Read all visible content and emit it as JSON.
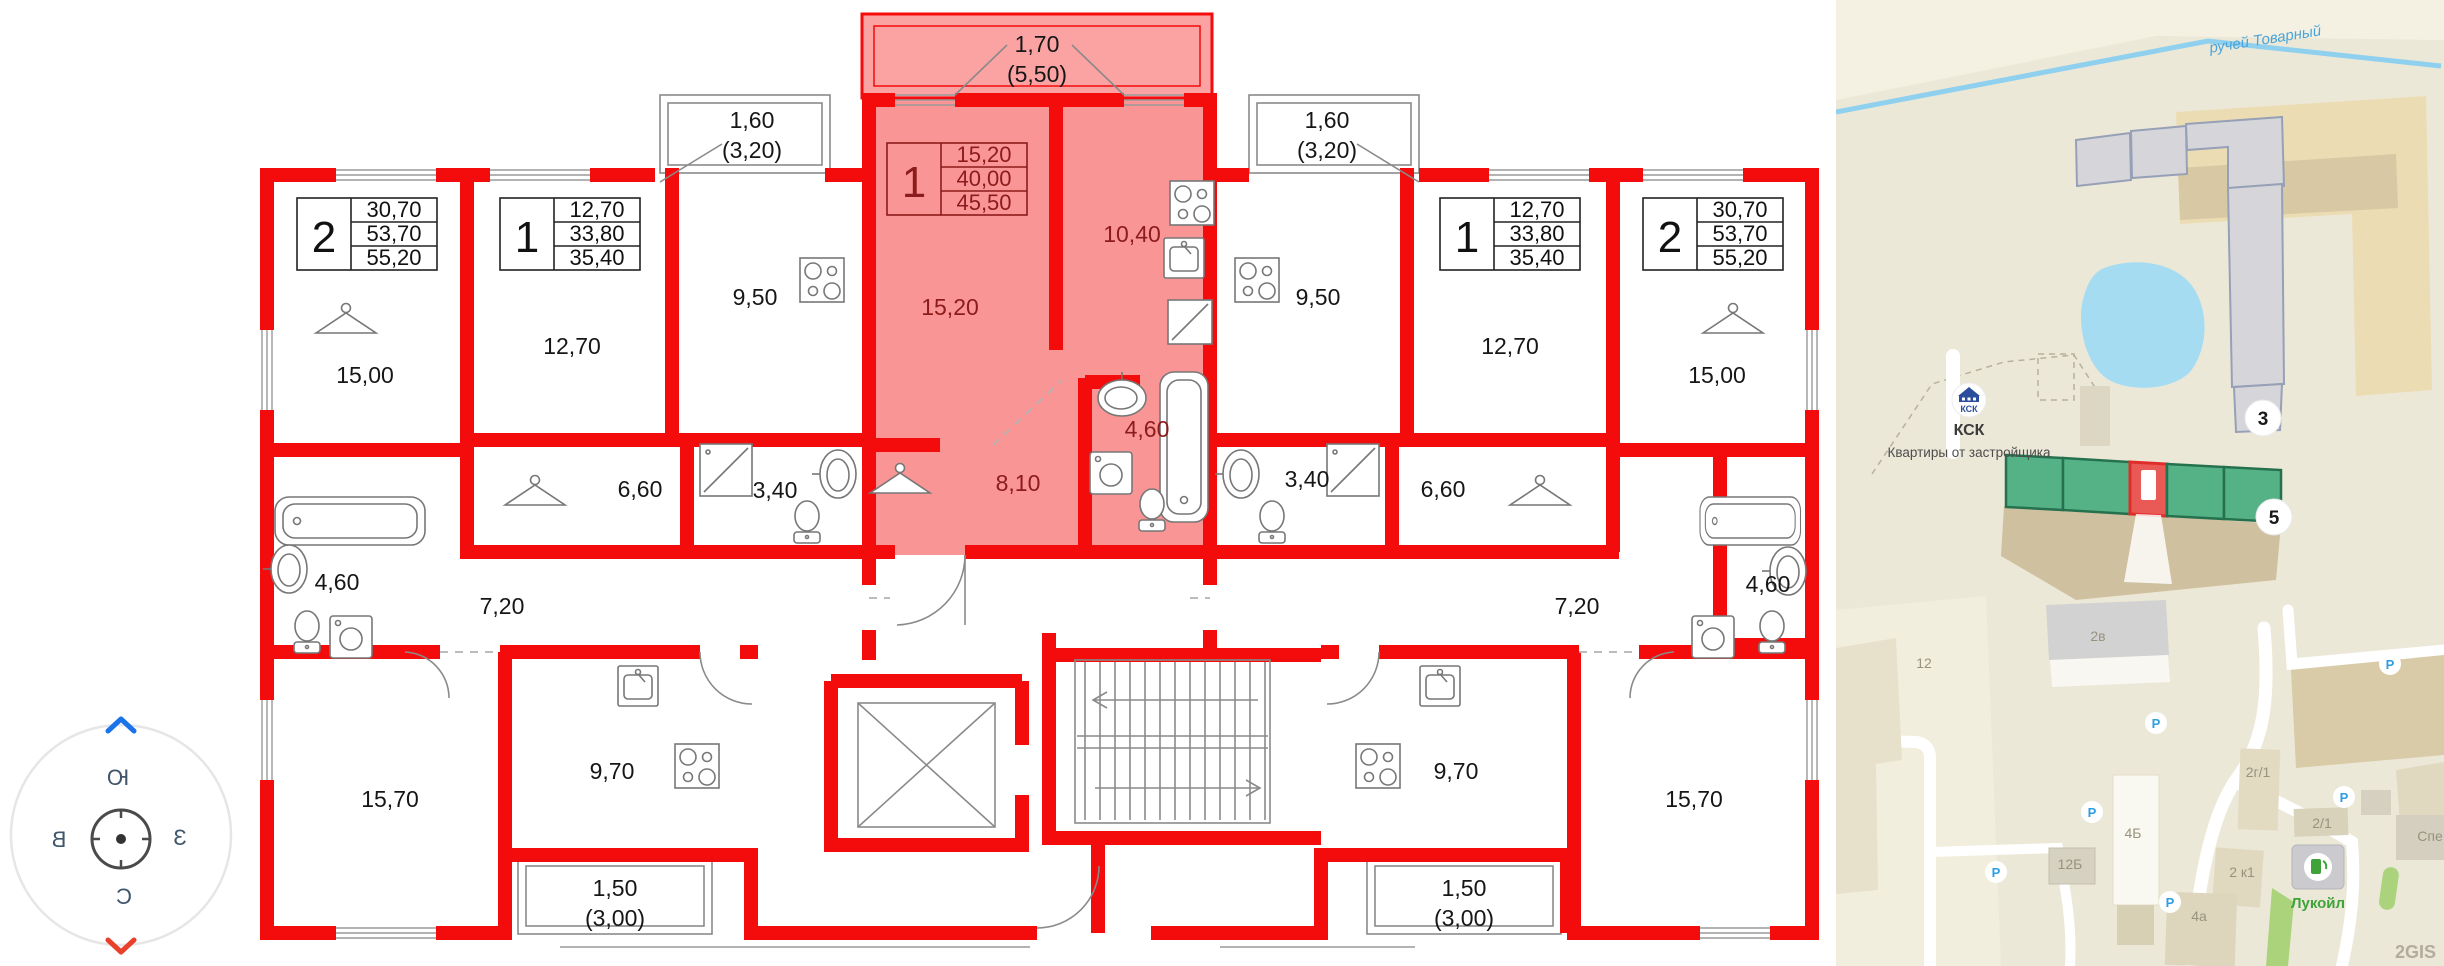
{
  "floorplan": {
    "units": [
      {
        "num": "2",
        "a1": "30,70",
        "a2": "53,70",
        "a3": "55,20"
      },
      {
        "num": "1",
        "a1": "12,70",
        "a2": "33,80",
        "a3": "35,40"
      },
      {
        "num": "1",
        "a1": "15,20",
        "a2": "40,00",
        "a3": "45,50"
      },
      {
        "num": "1",
        "a1": "12,70",
        "a2": "33,80",
        "a3": "35,40"
      },
      {
        "num": "2",
        "a1": "30,70",
        "a2": "53,70",
        "a3": "55,20"
      }
    ],
    "rooms": {
      "l2_room": "15,00",
      "l2_bath": "4,60",
      "l2_hall": "7,20",
      "l2_room2": "15,70",
      "l2_kitchen": "9,70",
      "l1_room": "12,70",
      "l1_kitchen": "9,50",
      "l1_bath": "3,40",
      "l1_ward": "6,60",
      "c_room": "15,20",
      "c_kitchen": "10,40",
      "c_hall": "8,10",
      "c_bath": "4,60",
      "r1_room": "12,70",
      "r1_kitchen": "9,50",
      "r1_bath": "3,40",
      "r1_ward": "6,60",
      "r2_room": "15,00",
      "r2_bath": "4,60",
      "r2_hall": "7,20",
      "r2_room2": "15,70",
      "r2_kitchen": "9,70"
    },
    "balconies": {
      "top_left": "1,60",
      "top_left_sub": "(3,20)",
      "center": "1,70",
      "center_sub": "(5,50)",
      "top_right": "1,60",
      "top_right_sub": "(3,20)",
      "bottom_left": "1,50",
      "bottom_left_sub": "(3,00)",
      "bottom_right": "1,50",
      "bottom_right_sub": "(3,00)"
    },
    "compass": {
      "south": "Ю",
      "north": "С",
      "west": "З",
      "east": "В"
    }
  },
  "map": {
    "stream": "ручей Товарный",
    "developer_logo": "КСК",
    "developer_name": "КСК",
    "developer_tagline": "Квартиры от застройщика",
    "marker_3": "3",
    "marker_5": "5",
    "buildings": {
      "b2v": "2в",
      "b12": "12",
      "b2g1": "2г/1",
      "b4b": "4Б",
      "b12b": "12Б",
      "b21": "2/1",
      "b2k1": "2 к1",
      "b4a": "4а",
      "partial": "Спе"
    },
    "lukoil": "Лукойл",
    "parking": "P",
    "watermark": "2GIS",
    "colors": {
      "highlight_section": "#e95955",
      "section_green": "#55b286",
      "plan_red": "#f40b0b",
      "plan_highlight": "#fa9595"
    }
  }
}
